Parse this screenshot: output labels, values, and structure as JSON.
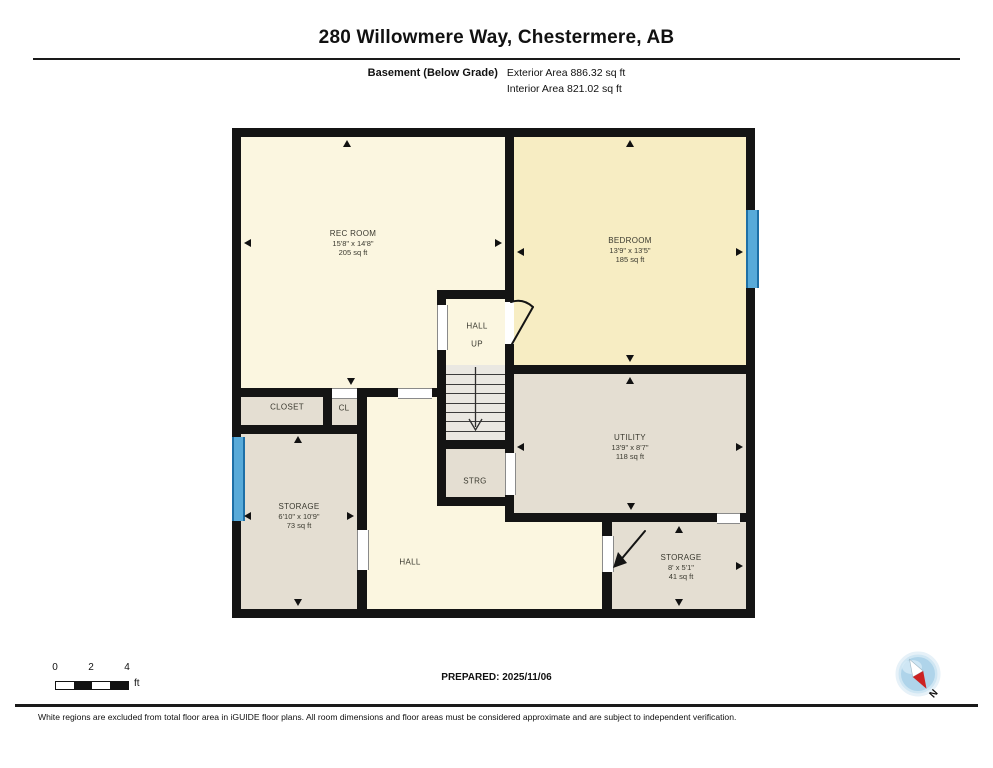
{
  "header": {
    "title": "280 Willowmere Way, Chestermere, AB",
    "floor_label": "Basement (Below Grade)",
    "exterior_area": "Exterior Area 886.32 sq ft",
    "interior_area": "Interior Area 821.02 sq ft"
  },
  "footer": {
    "prepared": "PREPARED: 2025/11/06",
    "disclaimer": "White regions are excluded from total floor area in iGUIDE floor plans. All room dimensions and floor areas must be considered approximate and are subject to independent verification.",
    "scale": {
      "t0": "0",
      "t1": "2",
      "t2": "4",
      "unit": "ft"
    },
    "compass_n": "N"
  },
  "colors": {
    "wall": "#141414",
    "room_cream": "#FBF6E0",
    "room_gold": "#F7EDC3",
    "room_tan": "#E4DED2",
    "stairs": "#EAE8E2",
    "window_blue": "#58AAD9",
    "compass_blue": "#AFD4EA",
    "compass_red": "#CC2222"
  },
  "floorplan": {
    "fills": [
      {
        "x": 241,
        "y": 137,
        "w": 264,
        "h": 260,
        "c": "cream"
      },
      {
        "x": 514,
        "y": 137,
        "w": 232,
        "h": 228,
        "c": "gold"
      },
      {
        "x": 446,
        "y": 299,
        "w": 59,
        "h": 66,
        "c": "cream"
      },
      {
        "x": 514,
        "y": 374,
        "w": 232,
        "h": 139,
        "c": "tan"
      },
      {
        "x": 446,
        "y": 449,
        "w": 59,
        "h": 48,
        "c": "tan"
      },
      {
        "x": 241,
        "y": 397,
        "w": 82,
        "h": 37,
        "c": "tan"
      },
      {
        "x": 332,
        "y": 397,
        "w": 25,
        "h": 37,
        "c": "tan"
      },
      {
        "x": 241,
        "y": 434,
        "w": 116,
        "h": 175,
        "c": "tan"
      },
      {
        "x": 367,
        "y": 397,
        "w": 70,
        "h": 212,
        "c": "cream"
      },
      {
        "x": 437,
        "y": 506,
        "w": 77,
        "h": 103,
        "c": "cream"
      },
      {
        "x": 514,
        "y": 522,
        "w": 88,
        "h": 87,
        "c": "cream"
      },
      {
        "x": 602,
        "y": 522,
        "w": 144,
        "h": 87,
        "c": "tan"
      },
      {
        "x": 446,
        "y": 365,
        "w": 59,
        "h": 75,
        "c": "stair"
      }
    ],
    "stairs": {
      "x": 446,
      "y": 365,
      "w": 59,
      "h": 75,
      "treads": 7
    },
    "walls": [
      {
        "x": 232,
        "y": 128,
        "w": 523,
        "h": 9
      },
      {
        "x": 232,
        "y": 609,
        "w": 523,
        "h": 9
      },
      {
        "x": 232,
        "y": 128,
        "w": 9,
        "h": 490
      },
      {
        "x": 746,
        "y": 128,
        "w": 9,
        "h": 490
      },
      {
        "x": 505,
        "y": 137,
        "w": 9,
        "h": 165
      },
      {
        "x": 505,
        "y": 344,
        "w": 9,
        "h": 105
      },
      {
        "x": 505,
        "y": 365,
        "w": 241,
        "h": 9
      },
      {
        "x": 437,
        "y": 290,
        "w": 77,
        "h": 9
      },
      {
        "x": 437,
        "y": 290,
        "w": 9,
        "h": 216
      },
      {
        "x": 241,
        "y": 388,
        "w": 157,
        "h": 9
      },
      {
        "x": 432,
        "y": 388,
        "w": 14,
        "h": 9
      },
      {
        "x": 323,
        "y": 388,
        "w": 9,
        "h": 46
      },
      {
        "x": 357,
        "y": 388,
        "w": 10,
        "h": 230
      },
      {
        "x": 241,
        "y": 425,
        "w": 126,
        "h": 9
      },
      {
        "x": 437,
        "y": 440,
        "w": 77,
        "h": 9
      },
      {
        "x": 437,
        "y": 497,
        "w": 77,
        "h": 9
      },
      {
        "x": 505,
        "y": 449,
        "w": 9,
        "h": 73
      },
      {
        "x": 505,
        "y": 513,
        "w": 212,
        "h": 9
      },
      {
        "x": 740,
        "y": 513,
        "w": 6,
        "h": 9
      },
      {
        "x": 602,
        "y": 522,
        "w": 10,
        "h": 14
      },
      {
        "x": 602,
        "y": 572,
        "w": 10,
        "h": 37
      }
    ],
    "openings": [
      {
        "x": 437,
        "y": 305,
        "w": 9,
        "h": 45,
        "o": "v"
      },
      {
        "x": 332,
        "y": 388,
        "w": 25,
        "h": 9,
        "o": "h"
      },
      {
        "x": 398,
        "y": 388,
        "w": 34,
        "h": 9,
        "o": "h"
      },
      {
        "x": 505,
        "y": 453,
        "w": 9,
        "h": 42,
        "o": "v"
      },
      {
        "x": 357,
        "y": 530,
        "w": 10,
        "h": 40,
        "o": "v"
      },
      {
        "x": 717,
        "y": 513,
        "w": 23,
        "h": 9,
        "o": "h"
      },
      {
        "x": 602,
        "y": 536,
        "w": 10,
        "h": 36,
        "o": "v"
      }
    ],
    "windows": [
      {
        "x": 746,
        "y": 210,
        "w": 9,
        "h": 78
      },
      {
        "x": 232,
        "y": 437,
        "w": 9,
        "h": 84
      }
    ],
    "svg_paths": [
      {
        "d": "M 512 344 L 533 307",
        "t": "stroke"
      },
      {
        "d": "M 533 307 Q 523 298 511 302",
        "t": "stroke"
      },
      {
        "d": "M 645 531 L 619 562",
        "t": "stroke"
      },
      {
        "d": "M 613 568 L 627 563 L 618 552 Z",
        "t": "fill"
      },
      {
        "d": "M 475.5 367 L 475.5 427",
        "t": "thin"
      },
      {
        "d": "M 469 419 L 475.5 430 L 482 419",
        "t": "thin"
      }
    ],
    "arrows": [
      {
        "x": 347,
        "y": 140,
        "d": "up"
      },
      {
        "x": 244,
        "y": 243,
        "d": "left"
      },
      {
        "x": 502,
        "y": 243,
        "d": "right"
      },
      {
        "x": 351,
        "y": 385,
        "d": "down"
      },
      {
        "x": 630,
        "y": 140,
        "d": "up"
      },
      {
        "x": 517,
        "y": 252,
        "d": "left"
      },
      {
        "x": 743,
        "y": 252,
        "d": "right"
      },
      {
        "x": 630,
        "y": 362,
        "d": "down"
      },
      {
        "x": 630,
        "y": 377,
        "d": "up"
      },
      {
        "x": 517,
        "y": 447,
        "d": "left"
      },
      {
        "x": 743,
        "y": 447,
        "d": "right"
      },
      {
        "x": 631,
        "y": 510,
        "d": "down"
      },
      {
        "x": 298,
        "y": 436,
        "d": "up"
      },
      {
        "x": 244,
        "y": 516,
        "d": "left"
      },
      {
        "x": 354,
        "y": 516,
        "d": "right"
      },
      {
        "x": 298,
        "y": 606,
        "d": "down"
      },
      {
        "x": 679,
        "y": 526,
        "d": "up"
      },
      {
        "x": 743,
        "y": 566,
        "d": "right"
      },
      {
        "x": 679,
        "y": 606,
        "d": "down"
      }
    ],
    "labels": [
      {
        "x": 353,
        "y": 243,
        "lines": [
          "REC ROOM",
          "15'8\" x 14'8\"",
          "205 sq ft"
        ]
      },
      {
        "x": 630,
        "y": 250,
        "lines": [
          "BEDROOM",
          "13'9\" x 13'5\"",
          "185 sq ft"
        ]
      },
      {
        "x": 477,
        "y": 326,
        "lines": [
          "HALL"
        ]
      },
      {
        "x": 477,
        "y": 344,
        "lines": [
          "UP"
        ]
      },
      {
        "x": 287,
        "y": 407,
        "lines": [
          "CLOSET"
        ]
      },
      {
        "x": 344,
        "y": 408,
        "lines": [
          "CL"
        ]
      },
      {
        "x": 299,
        "y": 516,
        "lines": [
          "STORAGE",
          "6'10\" x 10'9\"",
          "73 sq ft"
        ]
      },
      {
        "x": 630,
        "y": 447,
        "lines": [
          "UTILITY",
          "13'9\" x 8'7\"",
          "118 sq ft"
        ]
      },
      {
        "x": 475,
        "y": 481,
        "lines": [
          "STRG"
        ]
      },
      {
        "x": 410,
        "y": 562,
        "lines": [
          "HALL"
        ]
      },
      {
        "x": 681,
        "y": 567,
        "lines": [
          "STORAGE",
          "8' x 5'1\"",
          "41 sq ft"
        ]
      }
    ]
  }
}
